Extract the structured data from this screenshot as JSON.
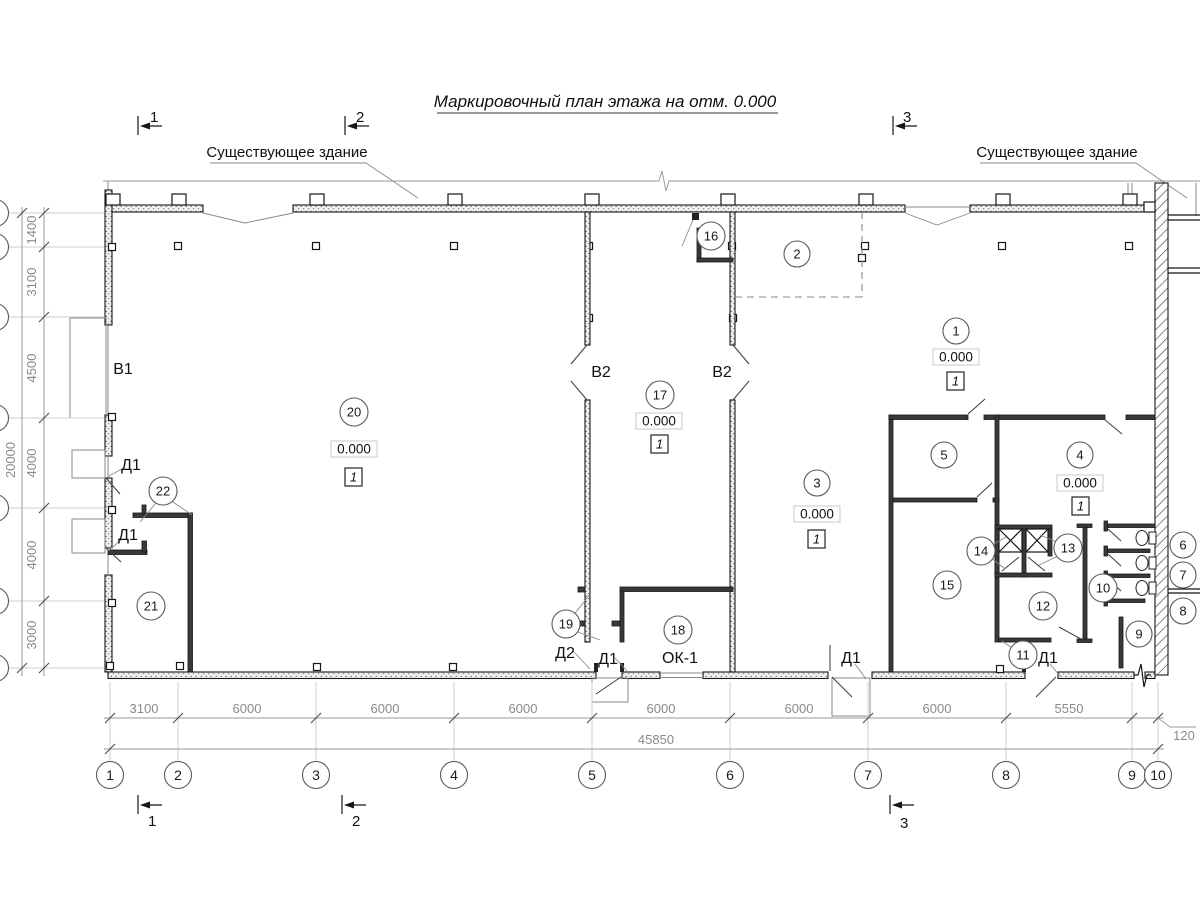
{
  "title": "Маркировочный план этажа на отм. 0.000",
  "labels": {
    "existing_left": "Существующее здание",
    "existing_right": "Существующее здание",
    "v1": "В1",
    "v2": "В2",
    "d1": "Д1",
    "d2": "Д2",
    "ok1": "ОК-1"
  },
  "sections": {
    "s1": "1",
    "s2": "2",
    "s3": "3"
  },
  "grid": {
    "cols": [
      "1",
      "2",
      "3",
      "4",
      "5",
      "6",
      "7",
      "8",
      "9",
      "10"
    ],
    "dims_bottom": [
      "3100",
      "6000",
      "6000",
      "6000",
      "6000",
      "6000",
      "6000",
      "5550"
    ],
    "dim_offset": "120",
    "total_bottom": "45850",
    "dims_left": [
      "1400",
      "3100",
      "4500",
      "4000",
      "4000",
      "3000"
    ],
    "total_left": "20000"
  },
  "elevation": "0.000",
  "floor_type": "1",
  "rooms": {
    "r1": "1",
    "r2": "2",
    "r3": "3",
    "r4": "4",
    "r5": "5",
    "r6": "6",
    "r7": "7",
    "r8": "8",
    "r9": "9",
    "r10": "10",
    "r11": "11",
    "r12": "12",
    "r13": "13",
    "r14": "14",
    "r15": "15",
    "r16": "16",
    "r17": "17",
    "r18": "18",
    "r19": "19",
    "r20": "20",
    "r21": "21",
    "r22": "22"
  }
}
